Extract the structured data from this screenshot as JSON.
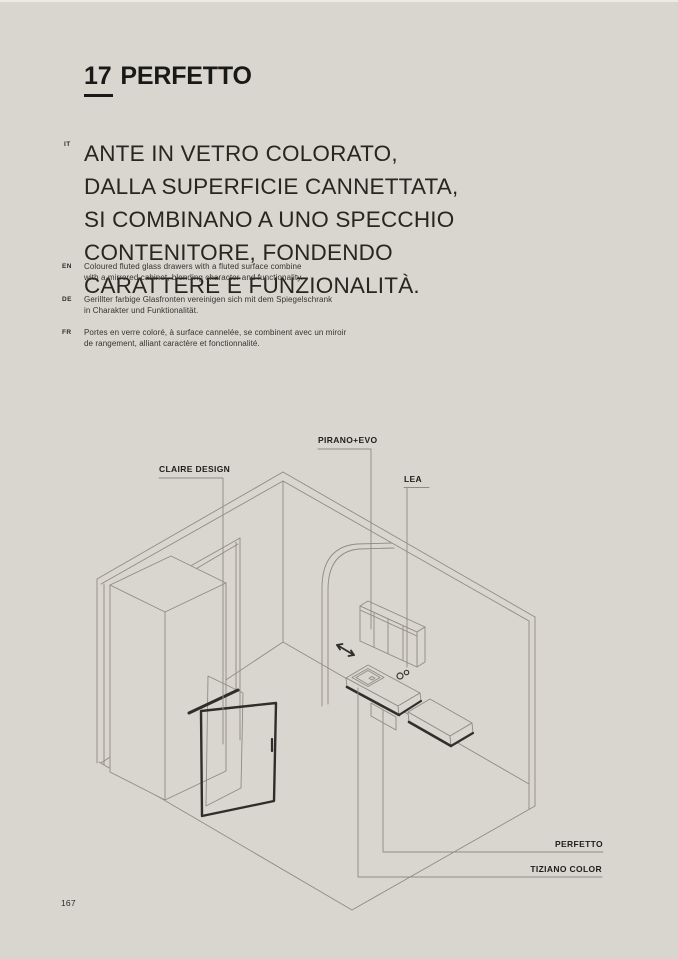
{
  "colors": {
    "background": "#d9d6cf",
    "text": "#191917",
    "line_thin": "#8f8c82",
    "line_dark": "#2f2e2a"
  },
  "header": {
    "chapter_number": "17",
    "chapter_title": "PERFETTO"
  },
  "headline": {
    "tag": "IT",
    "lines": [
      "ANTE IN VETRO COLORATO,",
      "DALLA SUPERFICIE CANNETTATA,",
      "SI COMBINANO A UNO SPECCHIO",
      "CONTENITORE, FONDENDO",
      "CARATTERE E FUNZIONALITÀ."
    ]
  },
  "translations": [
    {
      "tag": "EN",
      "lines": [
        "Coloured fluted glass drawers with a fluted surface combine",
        "with a mirrored cabinet, blending character and functionality."
      ]
    },
    {
      "tag": "DE",
      "lines": [
        "Gerillter farbige Glasfronten vereinigen sich mit dem Spiegelschrank",
        "in Charakter und Funktionalität."
      ]
    },
    {
      "tag": "FR",
      "lines": [
        "Portes en verre coloré, à surface cannelée, se combinent avec un miroir",
        "de rangement, alliant caractère et fonctionnalité."
      ]
    }
  ],
  "figure": {
    "labels": {
      "claire_design": "CLAIRE DESIGN",
      "pirano_evo": "PIRANO+EVO",
      "lea": "LEA",
      "perfetto": "PERFETTO",
      "tiziano_color": "TIZIANO COLOR"
    }
  },
  "page": {
    "number": "167"
  }
}
